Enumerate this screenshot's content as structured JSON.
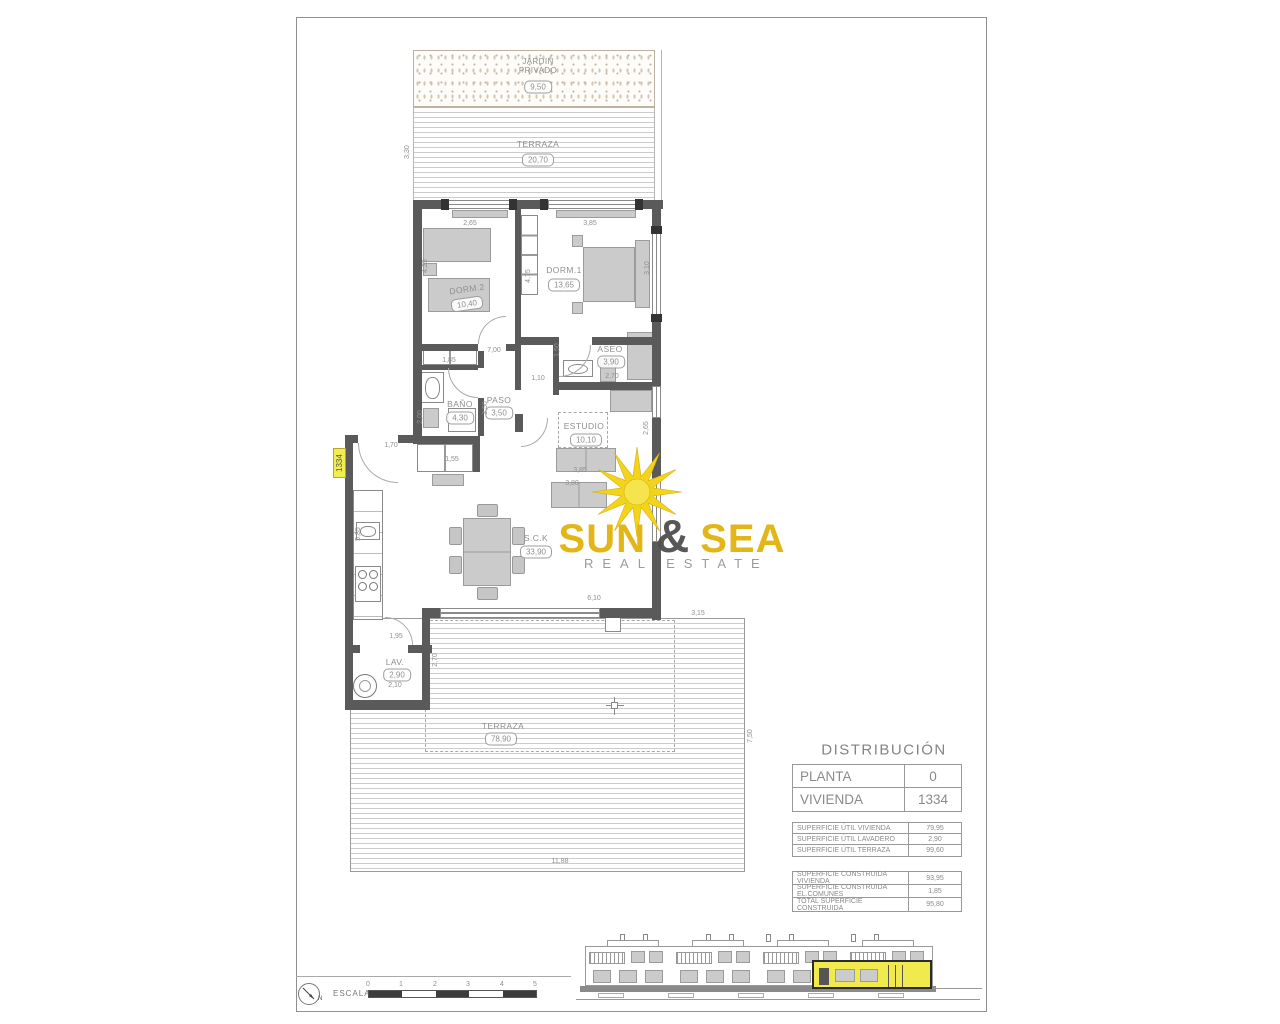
{
  "logo": {
    "sun": "SUN",
    "amp": "&",
    "sea": "SEA",
    "tagline": "REAL ESTATE"
  },
  "unit_tag": "1334",
  "rooms": {
    "jardin": {
      "label": "JARDIN PRIVADO",
      "area": "9,50"
    },
    "terraza_top": {
      "label": "TERRAZA",
      "area": "20,70"
    },
    "dorm2": {
      "label": "DORM.2",
      "area": "10,40"
    },
    "dorm1": {
      "label": "DORM.1",
      "area": "13,65"
    },
    "aseo": {
      "label": "ASEO",
      "area": "3,90"
    },
    "bano": {
      "label": "BAÑO",
      "area": "4,30"
    },
    "paso": {
      "label": "PASO",
      "area": "3,50"
    },
    "estudio": {
      "label": "ESTUDIO",
      "area": "10,10"
    },
    "sck": {
      "label": "S.C.K",
      "area": "33,90"
    },
    "lav": {
      "label": "LAV.",
      "area": "2,90"
    },
    "terraza": {
      "label": "TERRAZA",
      "area": "78,90"
    }
  },
  "dims": {
    "terr_top_h": "3,30",
    "dorm2_w": "2,65",
    "dorm1_w": "3,85",
    "dorm2_h": "4,25",
    "hall_h": "4,75",
    "dorm1_d": "3,10",
    "aseo_h": "1,50",
    "hall_w": "7,00",
    "closet_w": "1,85",
    "pass_w": "1,10",
    "aseo_w": "2,70",
    "bano_h": "2,00",
    "paso_h": "3,50",
    "shower_w": "1,55",
    "estudio_h": "2,65",
    "estudio_w": "3,85",
    "sofa_w": "3,80",
    "entry_w": "1,70",
    "kitchen_h": "5,85",
    "living_w": "6,10",
    "lav_door_w": "1,95",
    "lav_h": "2,70",
    "lav_w": "2,10",
    "terr_ne_w": "3,15",
    "terr_e_h": "7,50",
    "terr_s_w": "11,88"
  },
  "distribution": {
    "title": "DISTRIBUCIÓN",
    "main": [
      {
        "label": "PLANTA",
        "value": "0"
      },
      {
        "label": "VIVIENDA",
        "value": "1334"
      }
    ],
    "util": [
      {
        "label": "SUPERFICIE ÚTIL VIVIENDA",
        "value": "79,95"
      },
      {
        "label": "SUPERFICIE ÚTIL LAVADERO",
        "value": "2,90"
      },
      {
        "label": "SUPERFICIE ÚTIL TERRAZA",
        "value": "99,60"
      }
    ],
    "built": [
      {
        "label": "SUPERFICIE CONSTRUIDA VIVIENDA",
        "value": "93,95"
      },
      {
        "label": "SUPERFICIE CONSTRUIDA EL.COMUNES",
        "value": "1,85"
      },
      {
        "label": "TOTAL SUPERFICIE CONSTRUIDA",
        "value": "95,80"
      }
    ]
  },
  "scale": {
    "label": "ESCALA :",
    "ticks": [
      "0",
      "1",
      "2",
      "3",
      "4",
      "5"
    ],
    "north": "N"
  }
}
